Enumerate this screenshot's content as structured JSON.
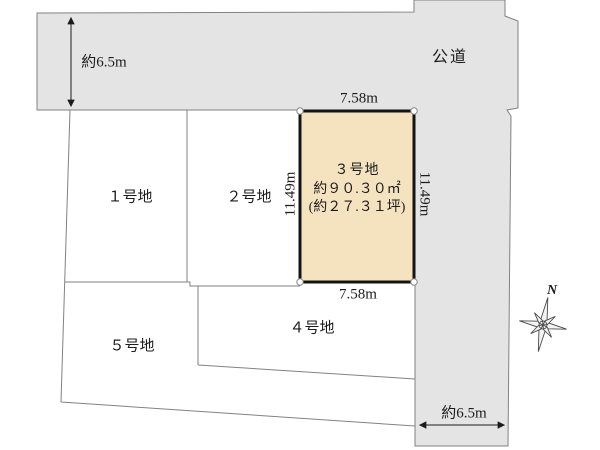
{
  "colors": {
    "road_fill": "#e4e4e5",
    "lot3_fill": "#f5e3c0",
    "boundary_line": "#828282",
    "lot3_border": "#141414"
  },
  "road": {
    "label": "公道",
    "width_top_left": "約6.5m",
    "width_bottom_right": "約6.5m"
  },
  "lot3": {
    "name": "３号地",
    "area_m2": "約９０.３０㎡",
    "area_tsubo": "(約２７.３１坪)",
    "width_top": "7.58m",
    "width_bottom": "7.58m",
    "depth_left": "11.49m",
    "depth_right": "11.49m"
  },
  "lots": {
    "lot1": "１号地",
    "lot2": "２号地",
    "lot4": "４号地",
    "lot5": "５号地"
  },
  "compass": {
    "north": "N"
  }
}
